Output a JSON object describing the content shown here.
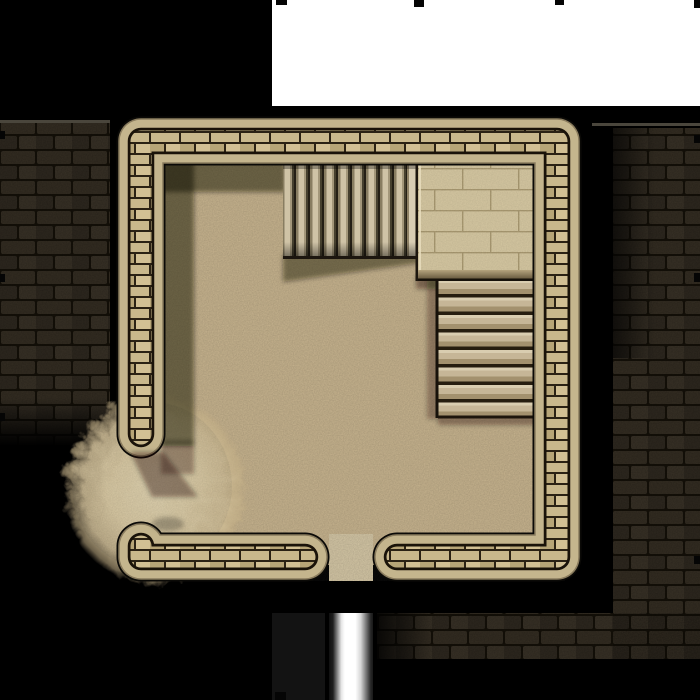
{
  "scene": {
    "type": "dungeon-battlemap-tile",
    "description": "Top-down square stone dungeon room with two staircases, a raised flagstone platform, a sand breach in the southwest wall, a south doorway leading to a metallic corridor, dark stone outer walls, and an unexplored white fog mask at the top.",
    "grid": {
      "cell_size_px": 140,
      "mark_color": "#050505"
    },
    "colors": {
      "background": "#000000",
      "fog_mask": "#ffffff",
      "floor": "#c6b28c",
      "floor_shadow": "#140f08",
      "sand_breach": "#d8c8a5",
      "wall_rim": "#c4b58d",
      "wall_brick_light": "#d2c094",
      "wall_brick_dark": "#b7a577",
      "wall_mortar": "#2b2214",
      "wall_outline": "#0b0a07",
      "outer_stone_brick": "#352e23",
      "outer_stone_mortar": "#151109",
      "outer_stone_highlight": "#4a463c",
      "platform_tile": "#d6c8a2",
      "stair_plank": "#cfc3a6",
      "tread_light": "#d9cdb0",
      "doorway_threshold": "#d3c5a3",
      "pillar_metal_center": "#ffffff",
      "corridor_dark_rect": "#131313"
    },
    "room": {
      "outer_bounds_px": "117,117 to 581,581",
      "wall_thickness_px": 45,
      "doorway": {
        "side": "south",
        "span_px": "330-372"
      },
      "breach": {
        "side": "southwest",
        "feature": "circular sand mound covering destroyed wall section"
      }
    },
    "features": [
      {
        "name": "north-staircase",
        "label": "Staircase descending west from platform",
        "steps": 10
      },
      {
        "name": "raised-platform",
        "label": "Raised flagstone landing, northeast corner"
      },
      {
        "name": "east-staircase",
        "label": "Staircase descending south from platform",
        "steps": 8
      },
      {
        "name": "sand-breach",
        "label": "Sand mound breaching southwest wall"
      },
      {
        "name": "south-doorway",
        "label": "Doorway with threshold stone"
      },
      {
        "name": "metal-pillar",
        "label": "Shiny metallic corridor strip below doorway"
      },
      {
        "name": "fog-of-war",
        "label": "White unexplored map mask, top edge"
      },
      {
        "name": "outer-wall-left",
        "label": "Dark stone outer wall, west side"
      },
      {
        "name": "outer-wall-right",
        "label": "Dark stone outer wall, east and southeast"
      }
    ]
  }
}
